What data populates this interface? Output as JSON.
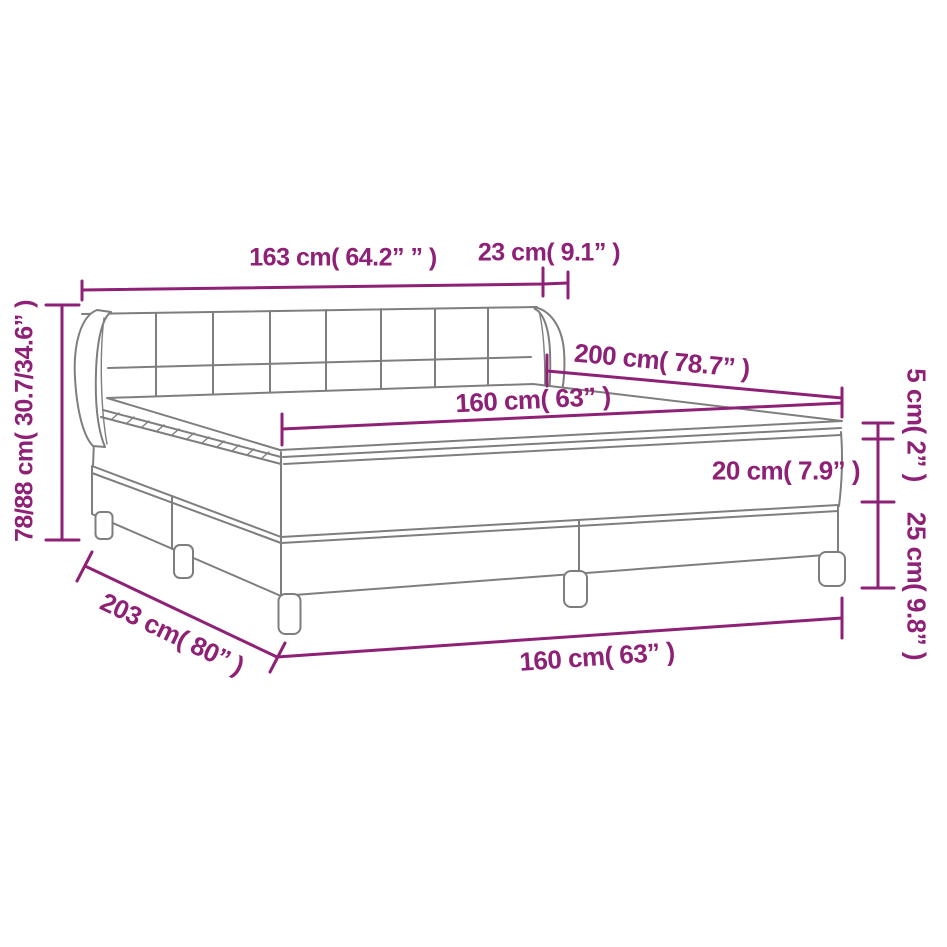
{
  "colors": {
    "dimension": "#8E2176",
    "outline": "#7E7E7E"
  },
  "diagram": {
    "type": "furniture-dimension-drawing",
    "subject": "box-spring-bed-with-headboard-topper-and-legs"
  },
  "labels": {
    "headboard_width": "163 cm( 64.2” ” )",
    "wing_depth": "23 cm( 9.1” )",
    "bed_height": "78/88 cm( 30.7/34.6” )",
    "bed_length": "200 cm( 78.7” )",
    "mattress_width": "160 cm( 63” )",
    "topper_height": "5 cm( 2” )",
    "mattress_height": "20 cm( 7.9” )",
    "base_height": "25 cm( 9.8” )",
    "frame_length": "203 cm( 80” )",
    "frame_width": "160 cm( 63” )"
  }
}
